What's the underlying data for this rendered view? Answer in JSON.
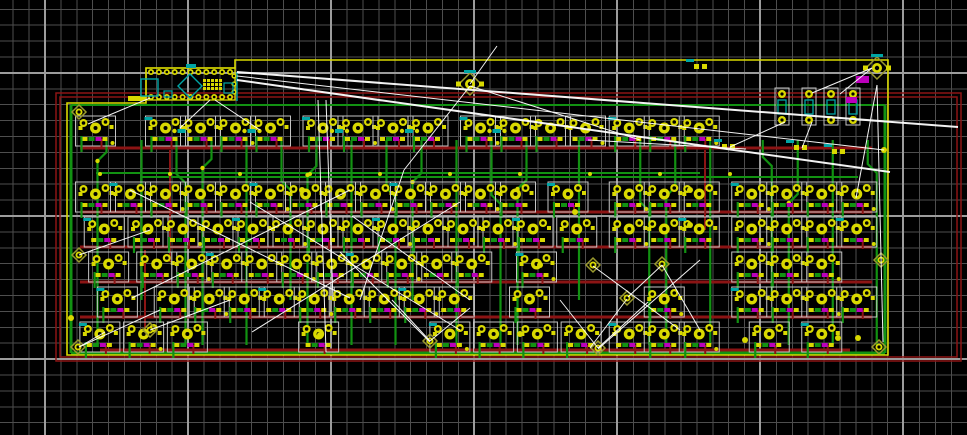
{
  "meta": {
    "app": "pcb-layout-editor",
    "view": "keyboard-matrix-board-canvas"
  },
  "canvas": {
    "width": 967,
    "height": 435,
    "background": "#000000"
  },
  "grid": {
    "minor_pitch": 15.9,
    "minor_offset_x": 13.2,
    "minor_offset_y": 9.3,
    "minor_color": "#4e4e4e",
    "major_color": "#9c9c9c",
    "majors_x": [
      45,
      188,
      331,
      474,
      617,
      760,
      903
    ],
    "majors_y": [
      73,
      216,
      359
    ]
  },
  "colors": {
    "copper_front": "#8c1414",
    "copper_back": "#129212",
    "pad": "#d9d900",
    "hole": "#000000",
    "silk": "#c4c4c4",
    "edge": "#d9d900",
    "ratsnest": "#ffffff",
    "teal": "#00a5a5",
    "magenta": "#bb00bb",
    "khaki": "#9a9a2e"
  },
  "board": {
    "outline_path": "M67,103 L146,103 L146,68 L235,68 L235,60 L888,60 L888,355 L67,355 Z",
    "keepout_rects": [
      {
        "x": 56,
        "y": 93,
        "w": 905,
        "h": 268
      },
      {
        "x": 60,
        "y": 97,
        "w": 897,
        "h": 260
      }
    ],
    "hug_traces": [
      {
        "x1": 71,
        "y1": 105,
        "x2": 71,
        "y2": 353,
        "c": "copper_back",
        "w": 3
      },
      {
        "x1": 885,
        "y1": 105,
        "x2": 885,
        "y2": 353,
        "c": "copper_back",
        "w": 3
      },
      {
        "x1": 71,
        "y1": 353,
        "x2": 885,
        "y2": 353,
        "c": "copper_back",
        "w": 3
      },
      {
        "x1": 71,
        "y1": 105,
        "x2": 885,
        "y2": 105,
        "c": "copper_back",
        "w": 2
      }
    ]
  },
  "keyboard": {
    "unit_px": 35,
    "origin_x": 78,
    "rows": [
      {
        "y": 130,
        "units": [
          0.5,
          2.5,
          3.5,
          4.5,
          5.5,
          7,
          8,
          9,
          10,
          11.5,
          12.5,
          13.5,
          14.5,
          15.75,
          16.75,
          17.75
        ]
      },
      {
        "y": 196,
        "units": [
          0.5,
          1.5,
          2.5,
          3.5,
          4.5,
          5.5,
          6.5,
          7.5,
          8.5,
          9.5,
          10.5,
          11.5,
          12.5,
          14,
          15.75,
          16.75,
          17.75,
          19.25,
          20.25,
          21.25,
          22.25
        ]
      },
      {
        "y": 231,
        "units": [
          0.75,
          2,
          3,
          4,
          5,
          6,
          7,
          8,
          9,
          10,
          11,
          12,
          13,
          14.25,
          15.75,
          16.75,
          17.75,
          19.25,
          20.25,
          21.25,
          22.25
        ]
      },
      {
        "y": 266,
        "units": [
          0.875,
          2.25,
          3.25,
          4.25,
          5.25,
          6.25,
          7.25,
          8.25,
          9.25,
          10.25,
          11.25,
          13.1,
          19.25,
          20.25,
          21.25
        ]
      },
      {
        "y": 301,
        "units": [
          1.125,
          2.75,
          3.75,
          4.75,
          5.75,
          6.75,
          7.75,
          8.75,
          9.75,
          10.75,
          12.9,
          16.75,
          19.25,
          20.25,
          21.25,
          22.25
        ]
      },
      {
        "y": 336,
        "units": [
          0.625,
          1.875,
          3.125,
          6.875,
          10.625,
          11.875,
          13.125,
          14.375,
          15.75,
          16.75,
          17.75,
          19.75,
          21.25
        ]
      }
    ],
    "row_trace_y": [
      148,
      212,
      247,
      282,
      317,
      350
    ],
    "column_units": [
      0.5,
      1.5,
      2.5,
      3.5,
      4.5,
      5.5,
      6.5,
      7.5,
      8.5,
      9.5,
      10.5,
      11.5,
      12.5,
      14,
      15.75,
      16.75,
      17.75,
      19.25,
      20.25,
      21.25,
      22.25
    ],
    "bus_traces": [
      {
        "x1": 96,
        "y1": 173,
        "x2": 700,
        "y2": 173,
        "c": "copper_back",
        "w": 2
      },
      {
        "x1": 140,
        "y1": 177,
        "x2": 858,
        "y2": 177,
        "c": "copper_back",
        "w": 2
      },
      {
        "x1": 100,
        "y1": 350,
        "x2": 850,
        "y2": 350,
        "c": "copper_front",
        "w": 3
      }
    ],
    "extra_red_verticals": [
      {
        "x": 170,
        "y1": 150,
        "y2": 262
      },
      {
        "x": 145,
        "y1": 250,
        "y2": 332
      },
      {
        "x": 705,
        "y1": 150,
        "y2": 230
      }
    ]
  },
  "pro_micro": {
    "x": 146,
    "y": 68,
    "w": 89,
    "h": 32,
    "pads_per_row": 11,
    "left_bar": {
      "x": 128,
      "y": 96,
      "w": 18,
      "h": 5
    },
    "cyan_square": {
      "x": 141,
      "y": 79,
      "w": 17,
      "h": 17
    },
    "cyan_small": {
      "x": 164,
      "y": 91,
      "w": 8,
      "h": 6
    },
    "diamond": {
      "cx": 190,
      "cy": 86,
      "r": 12
    },
    "teal_bar": {
      "x": 186,
      "y": 64,
      "w": 10,
      "h": 4
    },
    "qfn": {
      "x": 203,
      "y": 79,
      "cols": 5,
      "rows": 3,
      "step": 4
    },
    "right_cyan": {
      "x": 224,
      "y": 83,
      "w": 9,
      "h": 10
    },
    "right_pads_x": 234
  },
  "led_resistors": {
    "y_top": 88,
    "height": 37,
    "xs": [
      782,
      809,
      831,
      853
    ]
  },
  "small_parts": [
    {
      "x": 728,
      "y": 147
    },
    {
      "x": 800,
      "y": 148
    },
    {
      "x": 838,
      "y": 152
    },
    {
      "x": 700,
      "y": 67
    }
  ],
  "magenta_pads": [
    {
      "x": 856,
      "y": 76,
      "w": 13,
      "h": 7
    },
    {
      "x": 846,
      "y": 97,
      "w": 11,
      "h": 6
    }
  ],
  "jumpers_large": [
    {
      "x": 470,
      "y": 84
    },
    {
      "x": 877,
      "y": 68
    }
  ],
  "mount_holes": [
    {
      "x": 79,
      "y": 112
    },
    {
      "x": 79,
      "y": 255
    },
    {
      "x": 78,
      "y": 347
    },
    {
      "x": 881,
      "y": 260
    },
    {
      "x": 879,
      "y": 347
    },
    {
      "x": 150,
      "y": 330
    },
    {
      "x": 430,
      "y": 341
    },
    {
      "x": 598,
      "y": 348
    },
    {
      "x": 593,
      "y": 265
    },
    {
      "x": 662,
      "y": 264
    },
    {
      "x": 627,
      "y": 298
    }
  ],
  "lone_pads": [
    [
      520,
      334
    ],
    [
      745,
      340
    ],
    [
      838,
      338
    ],
    [
      858,
      338
    ],
    [
      320,
      335
    ],
    [
      575,
      212
    ],
    [
      690,
      225
    ],
    [
      690,
      190
    ],
    [
      884,
      150
    ],
    [
      71,
      318
    ],
    [
      540,
      265
    ],
    [
      302,
      190
    ]
  ],
  "ratsnest": [
    [
      237,
      72,
      958,
      127,
      2
    ],
    [
      237,
      80,
      890,
      172,
      2
    ],
    [
      237,
      76,
      884,
      150,
      1
    ],
    [
      150,
      98,
      88,
      124,
      1
    ],
    [
      318,
      100,
      326,
      352,
      1
    ],
    [
      326,
      100,
      333,
      300,
      1
    ],
    [
      470,
      86,
      404,
      170,
      1
    ],
    [
      404,
      170,
      360,
      300,
      1
    ],
    [
      470,
      84,
      497,
      46,
      1
    ],
    [
      470,
      86,
      640,
      140,
      1
    ],
    [
      877,
      85,
      883,
      342,
      1
    ],
    [
      877,
      85,
      856,
      198,
      1
    ],
    [
      872,
      68,
      840,
      94,
      1
    ],
    [
      872,
      68,
      812,
      93,
      1
    ],
    [
      785,
      122,
      730,
      147,
      1
    ],
    [
      812,
      122,
      802,
      148,
      1
    ],
    [
      588,
      140,
      640,
      143,
      1
    ],
    [
      640,
      143,
      746,
      149,
      1
    ],
    [
      598,
      348,
      560,
      300,
      1
    ],
    [
      598,
      348,
      648,
      302,
      1
    ],
    [
      598,
      349,
      700,
      260,
      1
    ],
    [
      593,
      266,
      680,
      330,
      1
    ],
    [
      662,
      265,
      700,
      330,
      1
    ],
    [
      662,
      265,
      628,
      297,
      1
    ],
    [
      627,
      299,
      590,
      348,
      1
    ],
    [
      430,
      341,
      392,
      300,
      1
    ],
    [
      430,
      341,
      470,
      308,
      1
    ],
    [
      430,
      342,
      340,
      252,
      1
    ],
    [
      150,
      330,
      230,
      300,
      1
    ],
    [
      79,
      347,
      160,
      310,
      1
    ],
    [
      79,
      347,
      105,
      332,
      1
    ],
    [
      130,
      190,
      350,
      298,
      1
    ],
    [
      350,
      190,
      132,
      298,
      1
    ],
    [
      250,
      202,
      460,
      330,
      1
    ],
    [
      460,
      202,
      252,
      332,
      1
    ],
    [
      352,
      216,
      470,
      300,
      1
    ],
    [
      79,
      255,
      150,
      230,
      1
    ],
    [
      210,
      100,
      180,
      128,
      1
    ],
    [
      215,
      100,
      260,
      130,
      1
    ]
  ]
}
